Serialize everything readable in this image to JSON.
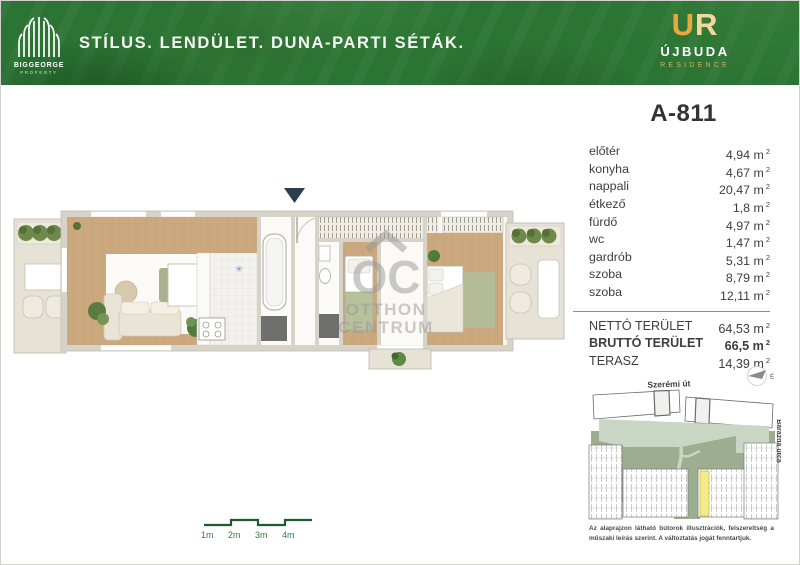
{
  "banner": {
    "brand_name": "BIGGEORGE",
    "brand_sub": "PROPERTY",
    "slogan": "STÍLUS. LENDÜLET. DUNA-PARTI SÉTÁK.",
    "logo_monogram_u": "U",
    "logo_monogram_r": "R",
    "logo_title": "ÚJBUDA",
    "logo_subtitle": "RESIDENCE"
  },
  "unit": {
    "id": "A-811",
    "unit_label": "m",
    "unit_sup": "2",
    "rooms": [
      {
        "name": "előtér",
        "area": "4,94"
      },
      {
        "name": "konyha",
        "area": "4,67"
      },
      {
        "name": "nappali",
        "area": "20,47"
      },
      {
        "name": "étkező",
        "area": "1,8"
      },
      {
        "name": "fürdő",
        "area": "4,97"
      },
      {
        "name": "wc",
        "area": "1,47"
      },
      {
        "name": "gardrób",
        "area": "5,31"
      },
      {
        "name": "szoba",
        "area": "8,79"
      },
      {
        "name": "szoba",
        "area": "12,11"
      }
    ],
    "totals": [
      {
        "name": "NETTÓ TERÜLET",
        "area": "64,53"
      },
      {
        "name": "BRUTTÓ TERÜLET",
        "area": "66,5"
      },
      {
        "name": "TERASZ",
        "area": "14,39"
      }
    ]
  },
  "floorplan": {
    "watermark_top": "OC",
    "watermark_mid": "OTTHON",
    "watermark_bottom": "CENTRUM"
  },
  "siteplan": {
    "street_top": "Szerémi út",
    "street_right": "Barázda utca",
    "north_label": "É"
  },
  "scalebar": [
    "1m",
    "2m",
    "3m",
    "4m"
  ],
  "disclaimer": "Az alaprajzon látható bútorok illusztrációk, felszereltség a műszaki leírás szerint. A változtatás jogát fenntartjuk.",
  "colors": {
    "banner_green": "#2c7434",
    "gold": "#eba63c",
    "scale_green": "#1d5c2a",
    "highlight_yellow": "#f1eb8a"
  }
}
